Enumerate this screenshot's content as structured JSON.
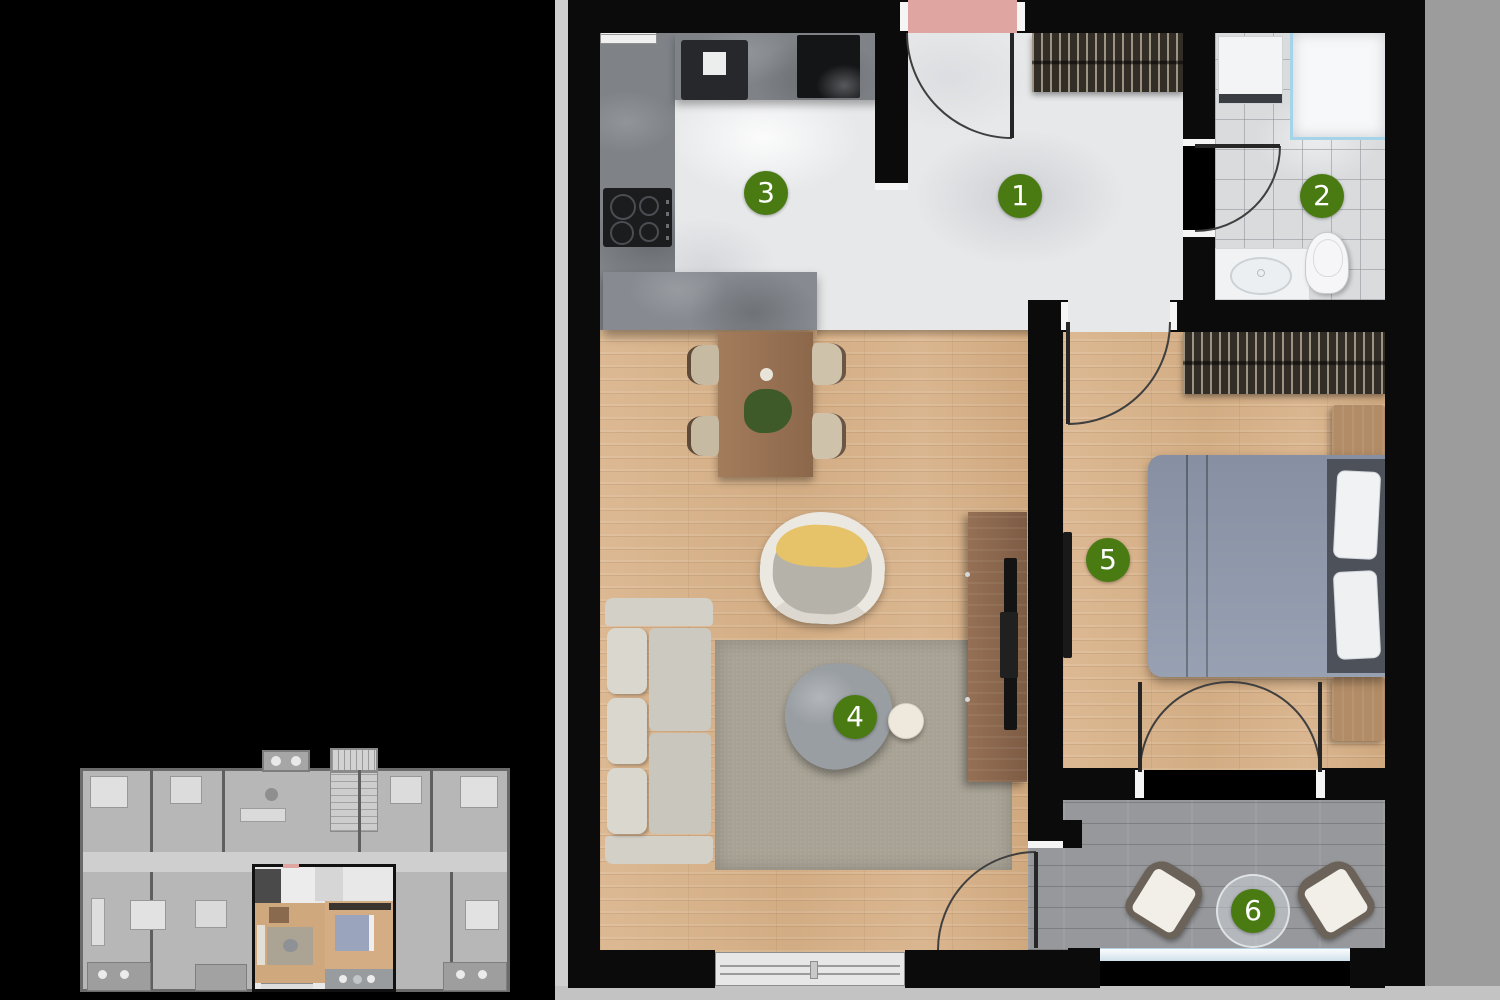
{
  "plan": {
    "type": "apartment-floor-plan",
    "markers": [
      {
        "number": "1"
      },
      {
        "number": "2"
      },
      {
        "number": "3"
      },
      {
        "number": "4"
      },
      {
        "number": "5"
      },
      {
        "number": "6"
      }
    ],
    "colors": {
      "marker_green": "#4a7b13",
      "entrance_mat_pink": "#dfa5a1",
      "wall_black": "#0b0b0b",
      "wood_floor": "#d8b48e",
      "shadow_gray": "#9c9c9c"
    }
  }
}
